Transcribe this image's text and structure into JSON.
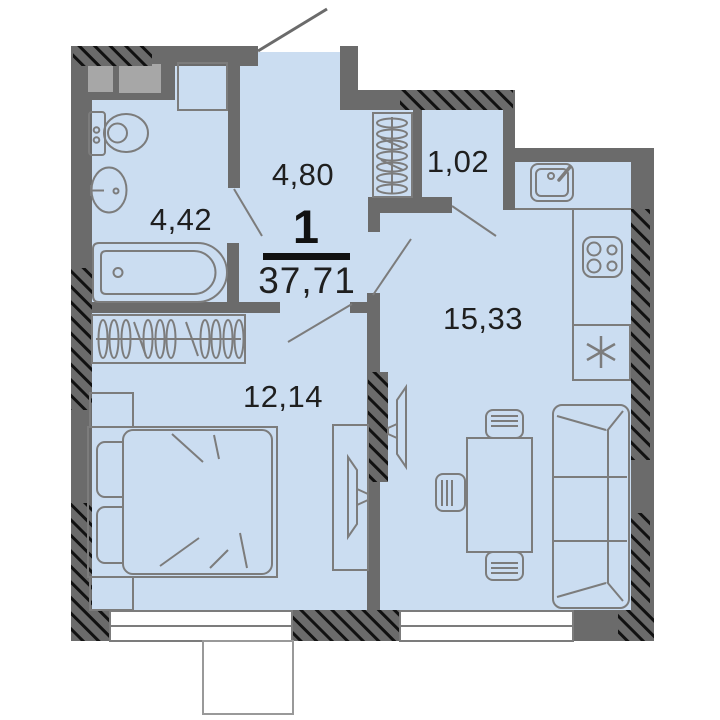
{
  "plan": {
    "unit_type": "1",
    "total_area": "37,71",
    "rooms": [
      {
        "name": "bathroom",
        "area": "4,42"
      },
      {
        "name": "hallway",
        "area": "4,80"
      },
      {
        "name": "storage-closet",
        "area": "1,02"
      },
      {
        "name": "kitchen-living-room",
        "area": "15,33"
      },
      {
        "name": "bedroom",
        "area": "12,14"
      }
    ],
    "colors": {
      "floor": "#cbddf1",
      "walls": "#6b6b6b",
      "vent_shaft": "#a7a7a7",
      "furniture_line": "#7c7c7c",
      "label_text": "#1f1f1f",
      "window": "#ffffff",
      "hatch": "#111111"
    },
    "furniture": [
      "toilet",
      "washbasin",
      "washing-machine",
      "bathtub",
      "coat-rack",
      "wardrobe",
      "double-bed",
      "pillows",
      "nightstands",
      "tv-console",
      "tv",
      "dining-table",
      "chairs",
      "sofa",
      "kitchen-sink",
      "stove",
      "refrigerator"
    ],
    "features": [
      "entry-door-swing",
      "bathroom-door-swing",
      "bedroom-door-swing",
      "living-door-swing",
      "closet-door-swing",
      "bedroom-window",
      "living-window",
      "balcony"
    ]
  }
}
